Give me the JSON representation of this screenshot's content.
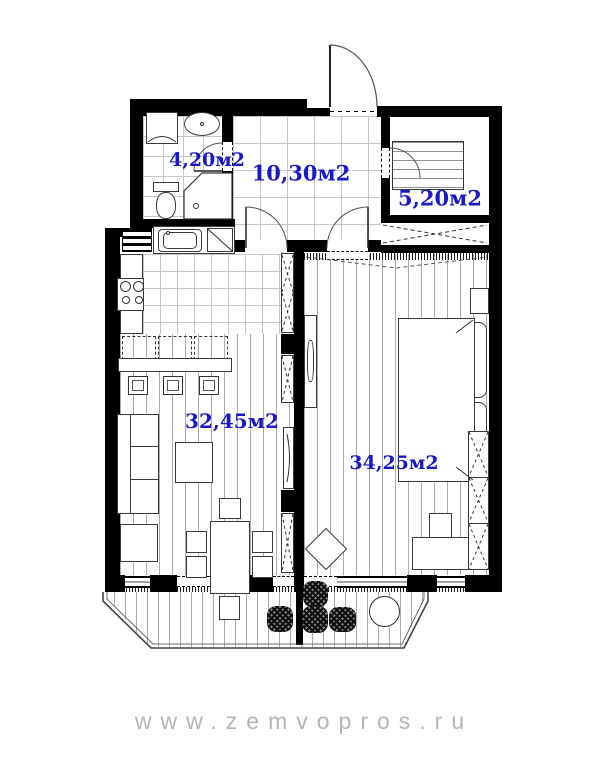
{
  "plan_title": "apartment-floor-plan",
  "watermark": "www.zemvopros.ru",
  "colors": {
    "label_blue": "#1b18c9",
    "wall_black": "#000000",
    "watermark_gray": "#b5b5b5"
  },
  "rooms": [
    {
      "id": "bathroom",
      "label": "4,20м2"
    },
    {
      "id": "hallway",
      "label": "10,30м2"
    },
    {
      "id": "closet-room",
      "label": "5,20м2"
    },
    {
      "id": "kitchen-living",
      "label": "32,45м2"
    },
    {
      "id": "bedroom",
      "label": "34,25м2"
    }
  ]
}
